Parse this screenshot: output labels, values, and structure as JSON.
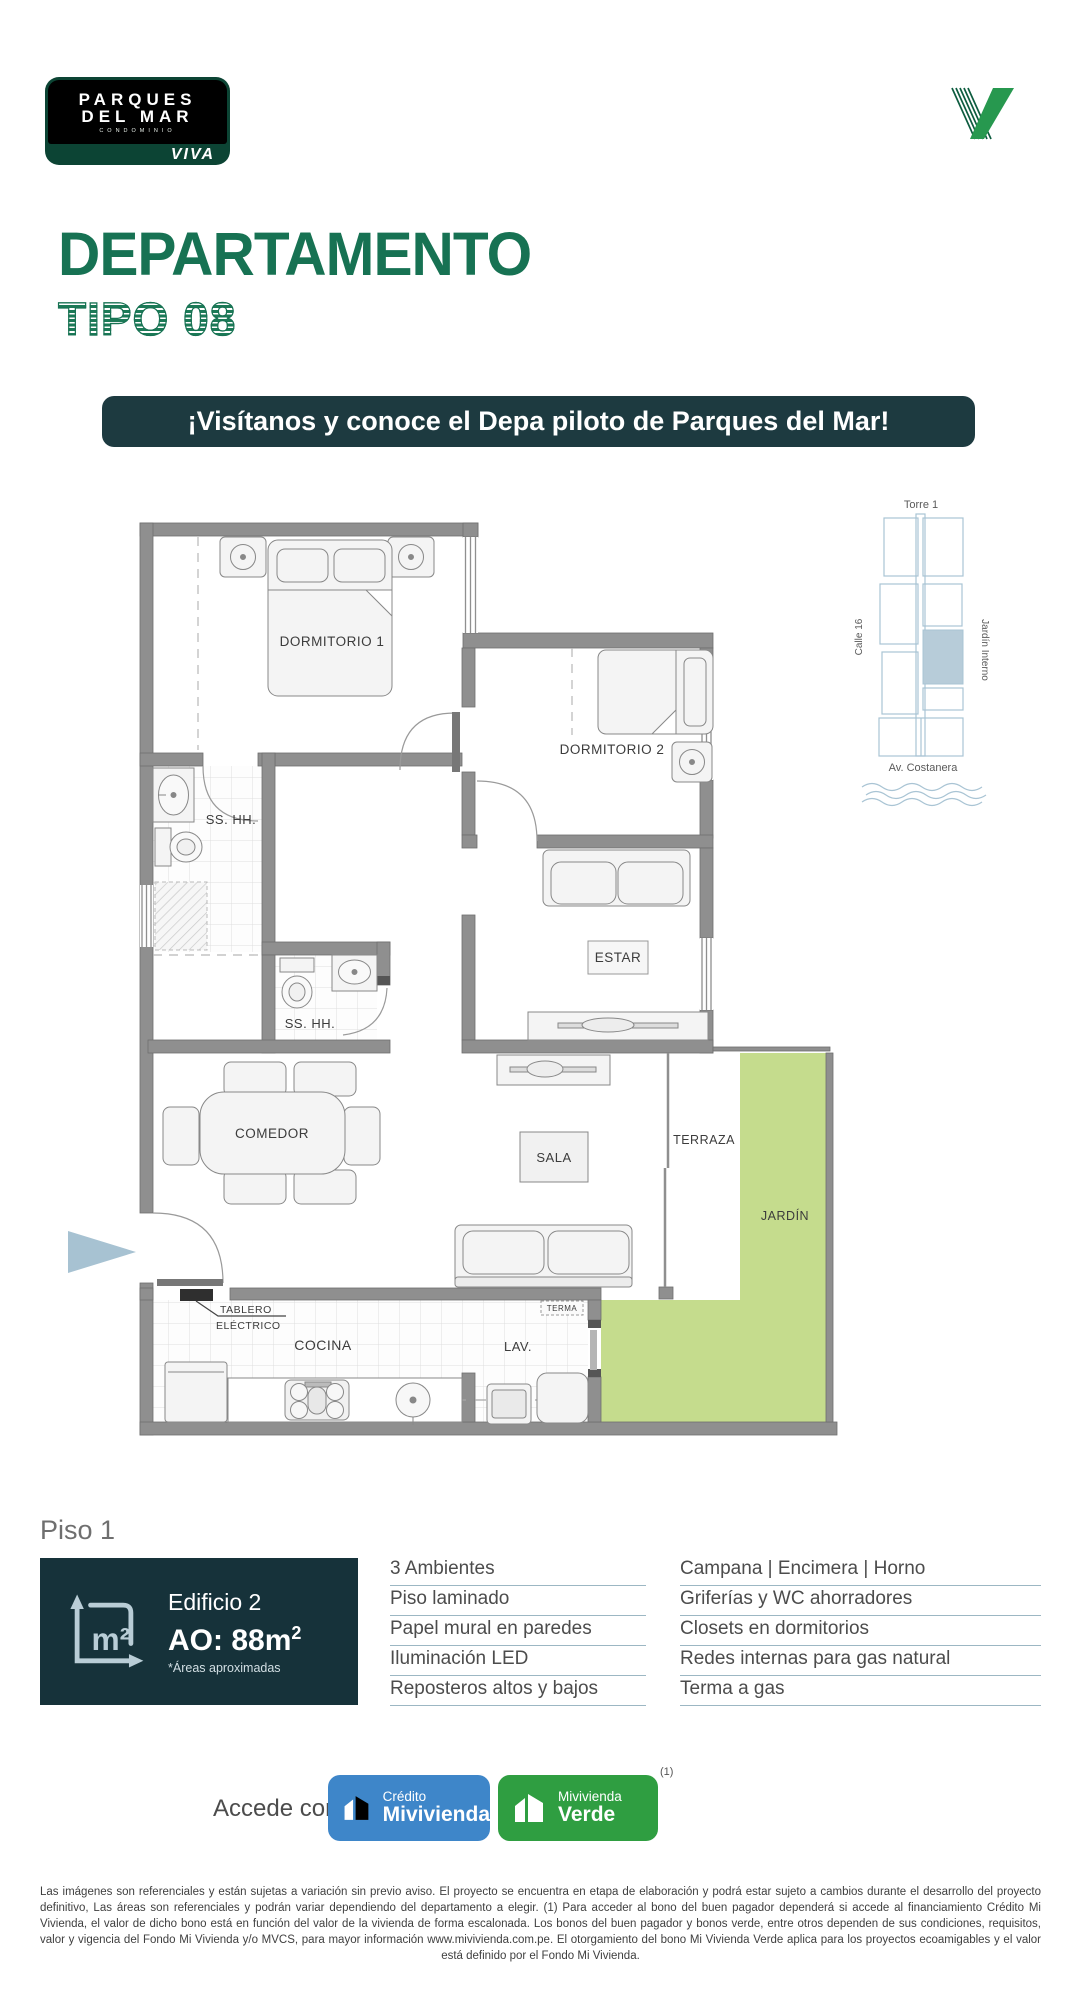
{
  "brand": {
    "name_line1": "PARQUES",
    "name_line2": "DEL MAR",
    "tagline": "CONDOMINIO",
    "viva": "VIVA"
  },
  "page": {
    "title": "DEPARTAMENTO",
    "subtitle": "TIPO 08"
  },
  "banner": {
    "text": "¡Visítanos y conoce el Depa piloto de Parques del Mar!"
  },
  "site_map": {
    "tower": "Torre 1",
    "street": "Calle 16",
    "inner_garden": "Jardín Interno",
    "avenue": "Av. Costanera"
  },
  "plan": {
    "dormitorio1": "DORMITORIO 1",
    "dormitorio2": "DORMITORIO 2",
    "bath1": "SS. HH.",
    "bath2": "SS. HH.",
    "estar": "ESTAR",
    "comedor": "COMEDOR",
    "sala": "SALA",
    "terraza": "TERRAZA",
    "jardin": "JARDÍN",
    "cocina": "COCINA",
    "lavanderia": "LAV.",
    "terma": "TERMA",
    "tablero_1": "TABLERO",
    "tablero_2": "ELÉCTRICO"
  },
  "summary": {
    "floor": "Piso 1",
    "building": "Edificio 2",
    "area": "AO: 88m",
    "area_sup": "2",
    "area_note": "*Áreas aproximadas",
    "unit_display": "m²"
  },
  "features": {
    "col1": [
      "3 Ambientes",
      "Piso laminado",
      "Papel mural en paredes",
      "Iluminación LED",
      "Reposteros altos y bajos"
    ],
    "col2": [
      "Campana | Encimera | Horno",
      "Griferías y WC ahorradores",
      "Closets en dormitorios",
      "Redes internas para gas natural",
      "Terma a gas"
    ]
  },
  "access": {
    "label": "Accede con:",
    "credit_button": {
      "line1": "Crédito",
      "line2": "Mivivienda"
    },
    "green_button": {
      "line1": "Mivivienda",
      "line2": "Verde",
      "note": "(1)"
    }
  },
  "disclaimer": "Las imágenes son referenciales y están sujetas a variación sin previo aviso. El proyecto se encuentra en etapa de elaboración y podrá estar sujeto a cambios durante el desarrollo del proyecto definitivo, Las áreas son referenciales y podrán variar dependiendo del departamento a elegir. (1) Para acceder al bono del buen pagador dependerá si accede al financiamiento Crédito Mi Vivienda, el valor de dicho bono está en función del valor de la vivienda de forma escalonada. Los bonos del buen pagador y bonos verde, entre otros dependen de sus condiciones, requisitos, valor y vigencia del Fondo Mi Vivienda y/o MVCS, para mayor información www.mivivienda.com.pe. El otorgamiento del bono Mi Vivienda Verde aplica para los proyectos ecoamigables y el valor está definido por el Fondo Mi Vivienda.",
  "colors": {
    "title_green": "#177253",
    "banner_bg": "#1d3a40",
    "box_bg": "#16323a",
    "garden_green": "#c5dc8d",
    "map_blue": "#a9c4d4",
    "credit_blue": "#3e86c9",
    "verde_green": "#2f9e41"
  }
}
